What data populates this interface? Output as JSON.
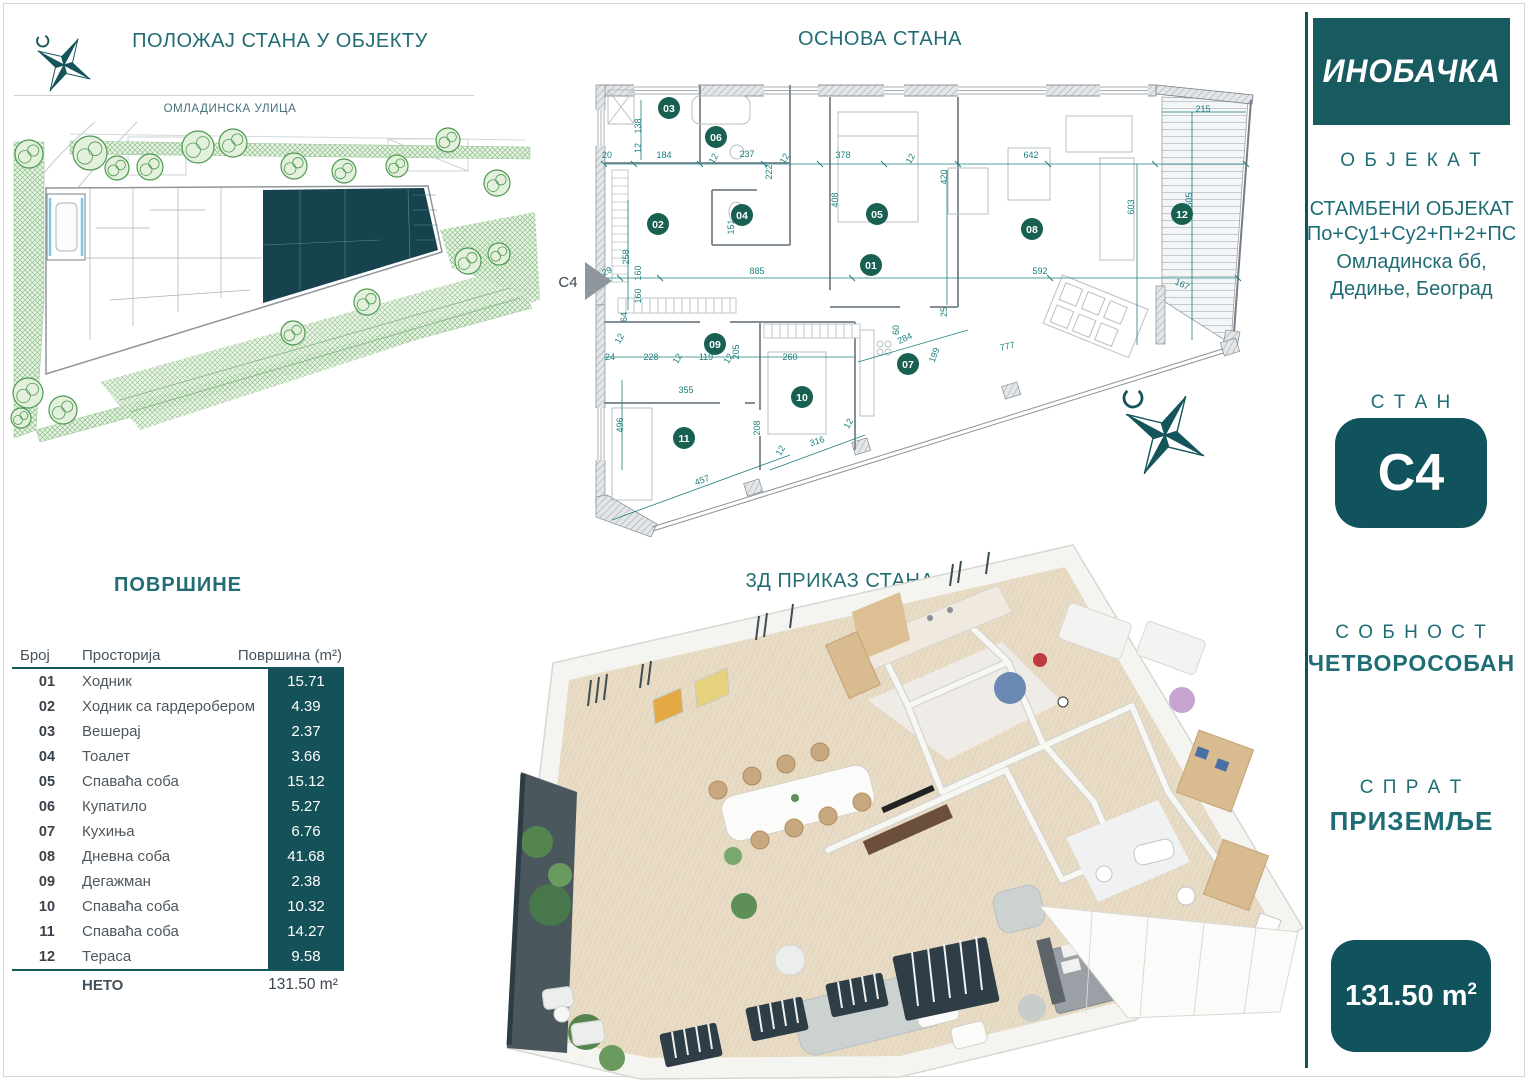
{
  "colors": {
    "teal": "#226d74",
    "badge": "#186051",
    "dim": "#1e8080",
    "box": "#10535c",
    "cell": "#155158",
    "unit_fill": "#16434e"
  },
  "site_plan": {
    "title": "ПОЛОЖАЈ СТАНА У ОБЈЕКТУ",
    "street_label": "ОМЛАДИНСКА УЛИЦА",
    "trees": [
      {
        "x": 29,
        "y": 154,
        "r": 14
      },
      {
        "x": 90,
        "y": 153,
        "r": 17
      },
      {
        "x": 117,
        "y": 168,
        "r": 12
      },
      {
        "x": 150,
        "y": 167,
        "r": 13
      },
      {
        "x": 198,
        "y": 147,
        "r": 16
      },
      {
        "x": 233,
        "y": 143,
        "r": 14
      },
      {
        "x": 294,
        "y": 166,
        "r": 13
      },
      {
        "x": 344,
        "y": 171,
        "r": 12
      },
      {
        "x": 397,
        "y": 166,
        "r": 11
      },
      {
        "x": 448,
        "y": 140,
        "r": 12
      },
      {
        "x": 497,
        "y": 183,
        "r": 13
      },
      {
        "x": 468,
        "y": 261,
        "r": 13
      },
      {
        "x": 499,
        "y": 254,
        "r": 11
      },
      {
        "x": 367,
        "y": 302,
        "r": 13
      },
      {
        "x": 293,
        "y": 333,
        "r": 12
      },
      {
        "x": 28,
        "y": 393,
        "r": 15
      },
      {
        "x": 63,
        "y": 410,
        "r": 14
      },
      {
        "x": 21,
        "y": 418,
        "r": 10
      }
    ]
  },
  "floor_plan": {
    "title": "ОСНОВА СТАНА",
    "entrance_label": "C4",
    "badges": [
      {
        "n": "01",
        "x": 871,
        "y": 265
      },
      {
        "n": "02",
        "x": 658,
        "y": 224
      },
      {
        "n": "03",
        "x": 669,
        "y": 108
      },
      {
        "n": "04",
        "x": 742,
        "y": 215
      },
      {
        "n": "05",
        "x": 877,
        "y": 214
      },
      {
        "n": "06",
        "x": 716,
        "y": 137
      },
      {
        "n": "07",
        "x": 908,
        "y": 364
      },
      {
        "n": "08",
        "x": 1032,
        "y": 229
      },
      {
        "n": "09",
        "x": 715,
        "y": 344
      },
      {
        "n": "10",
        "x": 802,
        "y": 397
      },
      {
        "n": "11",
        "x": 684,
        "y": 438
      },
      {
        "n": "12",
        "x": 1182,
        "y": 214
      }
    ],
    "dims": [
      {
        "t": "138",
        "x": 641,
        "y": 126,
        "r": -90
      },
      {
        "t": "12",
        "x": 641,
        "y": 148,
        "r": -90
      },
      {
        "t": "20",
        "x": 607,
        "y": 158,
        "r": 0
      },
      {
        "t": "184",
        "x": 664,
        "y": 158,
        "r": 0
      },
      {
        "t": "12",
        "x": 716,
        "y": 160,
        "r": -60
      },
      {
        "t": "237",
        "x": 747,
        "y": 157,
        "r": 0
      },
      {
        "t": "12",
        "x": 787,
        "y": 160,
        "r": -60
      },
      {
        "t": "378",
        "x": 843,
        "y": 158,
        "r": 0
      },
      {
        "t": "12",
        "x": 913,
        "y": 160,
        "r": -60
      },
      {
        "t": "642",
        "x": 1031,
        "y": 158,
        "r": 0
      },
      {
        "t": "222",
        "x": 772,
        "y": 172,
        "r": -90
      },
      {
        "t": "408",
        "x": 838,
        "y": 200,
        "r": -90
      },
      {
        "t": "420",
        "x": 947,
        "y": 177,
        "r": -90
      },
      {
        "t": "603",
        "x": 1134,
        "y": 207,
        "r": -90
      },
      {
        "t": "605",
        "x": 1192,
        "y": 200,
        "r": -90
      },
      {
        "t": "215",
        "x": 1203,
        "y": 112,
        "r": 0
      },
      {
        "t": "258",
        "x": 629,
        "y": 257,
        "r": -90
      },
      {
        "t": "151",
        "x": 734,
        "y": 227,
        "r": -90
      },
      {
        "t": "29",
        "x": 608,
        "y": 274,
        "r": -25
      },
      {
        "t": "160",
        "x": 641,
        "y": 273,
        "r": -90
      },
      {
        "t": "885",
        "x": 757,
        "y": 274,
        "r": 0
      },
      {
        "t": "160",
        "x": 641,
        "y": 296,
        "r": -90
      },
      {
        "t": "592",
        "x": 1040,
        "y": 274,
        "r": 0
      },
      {
        "t": "167",
        "x": 1181,
        "y": 287,
        "r": 25
      },
      {
        "t": "64",
        "x": 627,
        "y": 317,
        "r": -90
      },
      {
        "t": "12",
        "x": 622,
        "y": 340,
        "r": -60
      },
      {
        "t": "24",
        "x": 610,
        "y": 360,
        "r": 0
      },
      {
        "t": "228",
        "x": 651,
        "y": 360,
        "r": 0
      },
      {
        "t": "12",
        "x": 680,
        "y": 360,
        "r": -60
      },
      {
        "t": "119",
        "x": 706,
        "y": 360,
        "r": 0
      },
      {
        "t": "12",
        "x": 731,
        "y": 360,
        "r": -60
      },
      {
        "t": "260",
        "x": 790,
        "y": 360,
        "r": 0
      },
      {
        "t": "205",
        "x": 739,
        "y": 352,
        "r": -90
      },
      {
        "t": "60",
        "x": 899,
        "y": 330,
        "r": -90
      },
      {
        "t": "25",
        "x": 947,
        "y": 312,
        "r": -90
      },
      {
        "t": "284",
        "x": 906,
        "y": 341,
        "r": -25
      },
      {
        "t": "199",
        "x": 937,
        "y": 356,
        "r": -70
      },
      {
        "t": "777",
        "x": 1008,
        "y": 349,
        "r": -13
      },
      {
        "t": "355",
        "x": 686,
        "y": 393,
        "r": 0
      },
      {
        "t": "496",
        "x": 623,
        "y": 425,
        "r": -90
      },
      {
        "t": "208",
        "x": 760,
        "y": 428,
        "r": -90
      },
      {
        "t": "12",
        "x": 783,
        "y": 452,
        "r": -60
      },
      {
        "t": "316",
        "x": 818,
        "y": 444,
        "r": -18
      },
      {
        "t": "457",
        "x": 703,
        "y": 483,
        "r": -20
      },
      {
        "t": "12",
        "x": 851,
        "y": 425,
        "r": -60
      }
    ]
  },
  "render3d": {
    "title": "3Д ПРИКАЗ СТАНА"
  },
  "areas_table": {
    "title": "ПОВРШИНЕ",
    "columns": [
      "Број",
      "Просторија",
      "Површина (m²)"
    ],
    "rows": [
      {
        "num": "01",
        "name": "Ходник",
        "area": "15.71"
      },
      {
        "num": "02",
        "name": "Ходник са гардеробером",
        "area": "4.39"
      },
      {
        "num": "03",
        "name": "Вешерај",
        "area": "2.37"
      },
      {
        "num": "04",
        "name": "Тоалет",
        "area": "3.66"
      },
      {
        "num": "05",
        "name": "Спаваћа соба",
        "area": "15.12"
      },
      {
        "num": "06",
        "name": "Купатило",
        "area": "5.27"
      },
      {
        "num": "07",
        "name": "Кухиња",
        "area": "6.76"
      },
      {
        "num": "08",
        "name": "Дневна соба",
        "area": "41.68"
      },
      {
        "num": "09",
        "name": "Дегажман",
        "area": "2.38"
      },
      {
        "num": "10",
        "name": "Спаваћа соба",
        "area": "10.32"
      },
      {
        "num": "11",
        "name": "Спаваћа соба",
        "area": "14.27"
      },
      {
        "num": "12",
        "name": "Тераса",
        "area": "9.58"
      }
    ],
    "net_label": "НЕТО",
    "net_value": "131.50 m²"
  },
  "sidebar": {
    "logo": "ИНОБАЧКА",
    "object_label": "О Б Ј Е К А Т",
    "object_type": "СТАМБЕНИ ОБЈЕКАТ",
    "object_floors": "По+Су1+Су2+П+2+ПС",
    "address_line1": "Омладинска бб,",
    "address_line2": "Дедиње, Београд",
    "unit_label": "С Т А Н",
    "unit_value": "C4",
    "rooms_label": "С О Б Н О С Т",
    "rooms_value": "ЧЕТВОРОСОБАН",
    "floor_label": "С П Р А Т",
    "floor_value": "ПРИЗЕМЉЕ",
    "area_value": "131.50 m",
    "area_sup": "2"
  }
}
